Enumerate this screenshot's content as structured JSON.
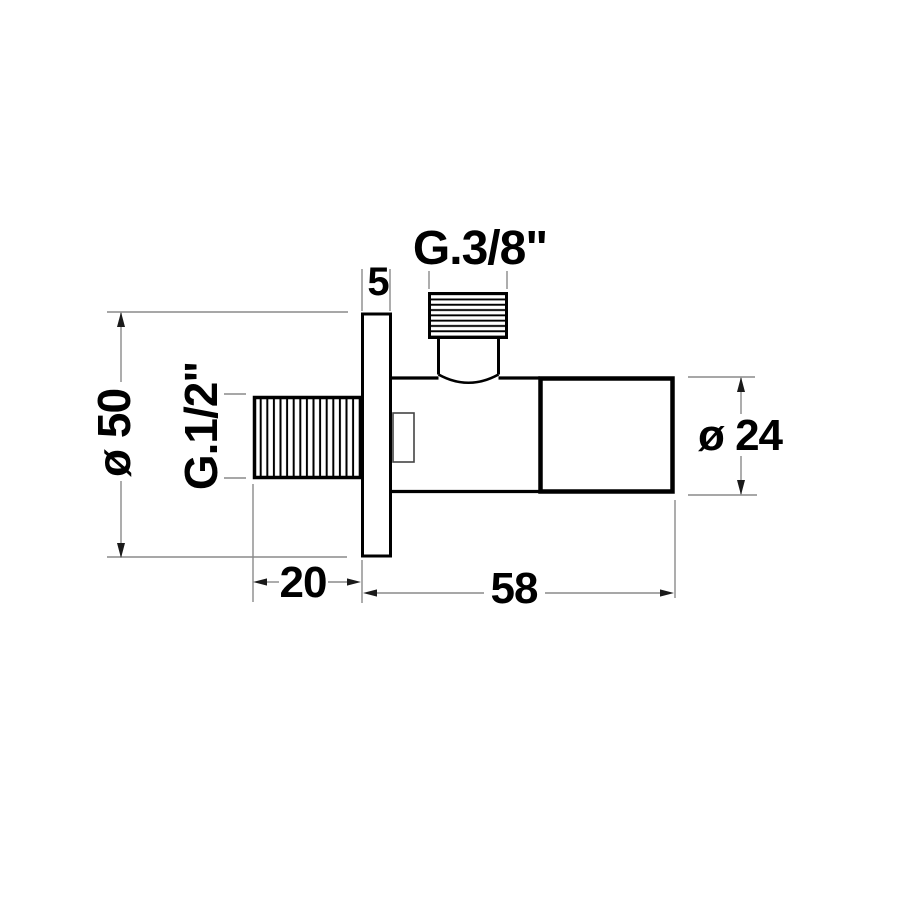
{
  "drawing": {
    "labels": {
      "top_thread": "G.3/8\"",
      "side_thread": "G.1/2\"",
      "plate_diameter": "ø 50",
      "body_diameter": "ø 24",
      "plate_thickness": "5",
      "thread_length": "20",
      "body_length": "58"
    },
    "colors": {
      "object_line": "#000000",
      "dimension_line": "#8a8a8a",
      "arrowhead": "#1a1a1a",
      "text": "#000000",
      "background": "#ffffff"
    }
  }
}
